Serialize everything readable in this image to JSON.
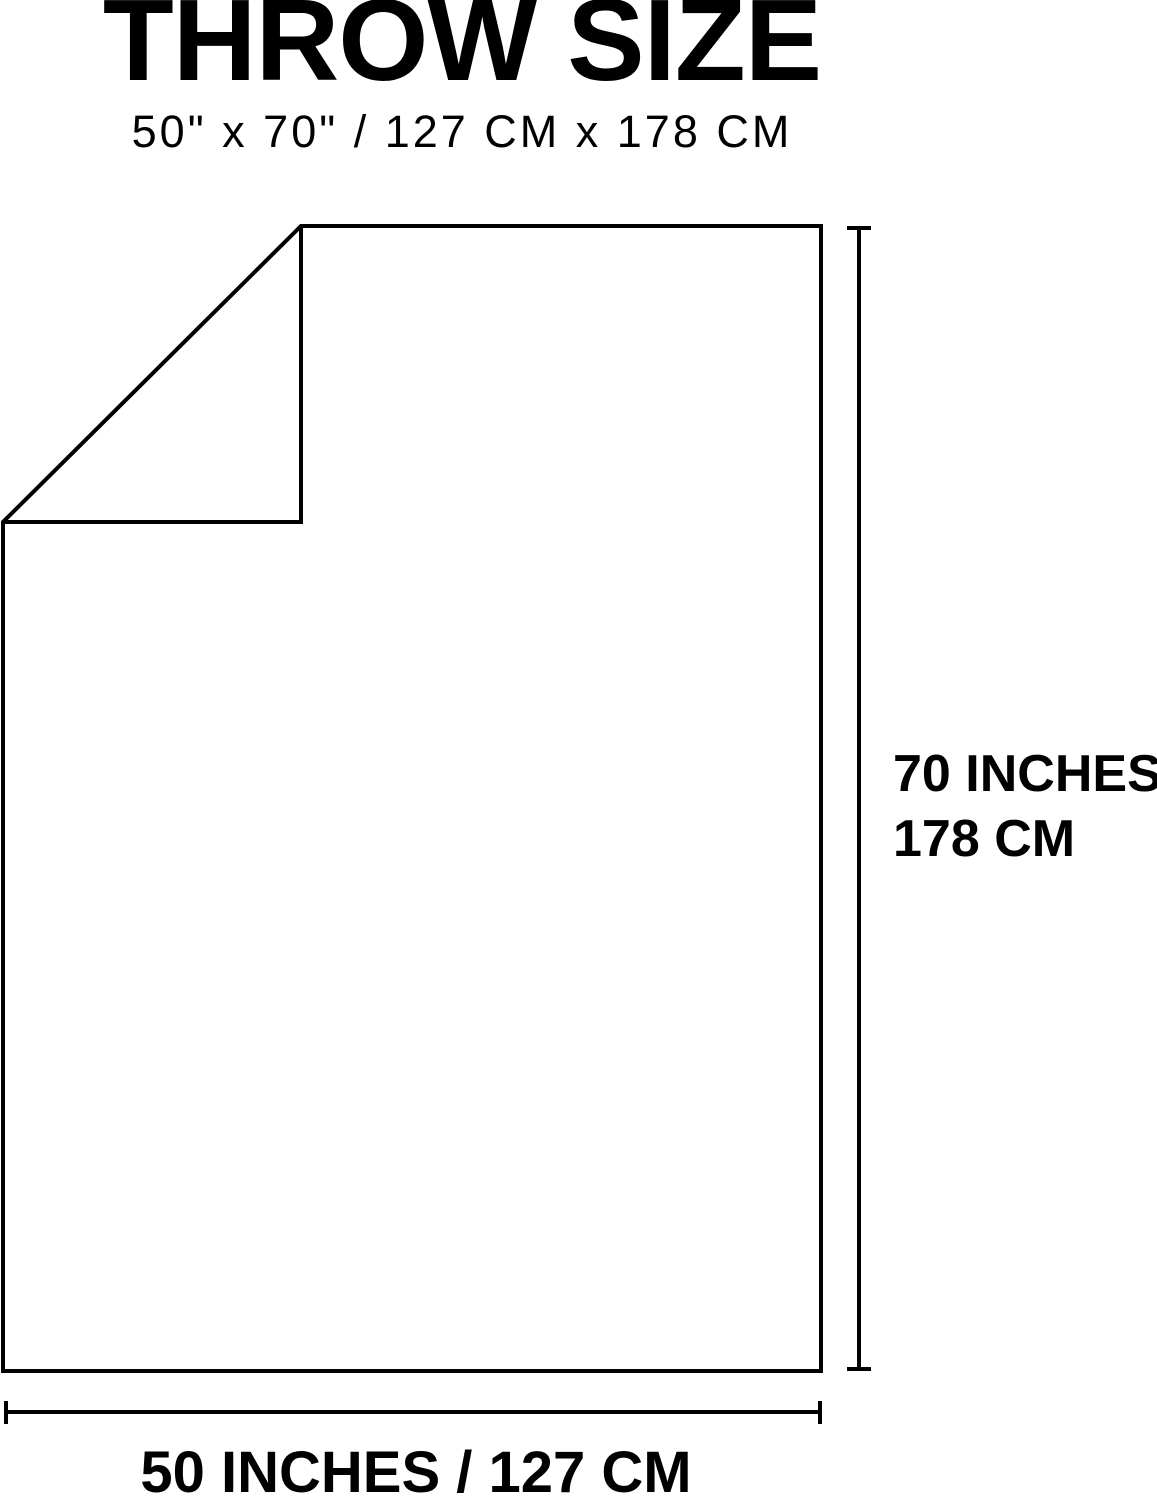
{
  "header": {
    "title": "THROW SIZE",
    "subtitle": "50\" x 70\" / 127 CM x 178 CM"
  },
  "diagram": {
    "height_dimension": {
      "line1": "70 INCHES",
      "line2": "178 CM"
    },
    "width_dimension": {
      "label": "50 INCHES / 127 CM"
    }
  },
  "colors": {
    "line": "#000000",
    "text": "#000000",
    "background": "#ffffff"
  }
}
